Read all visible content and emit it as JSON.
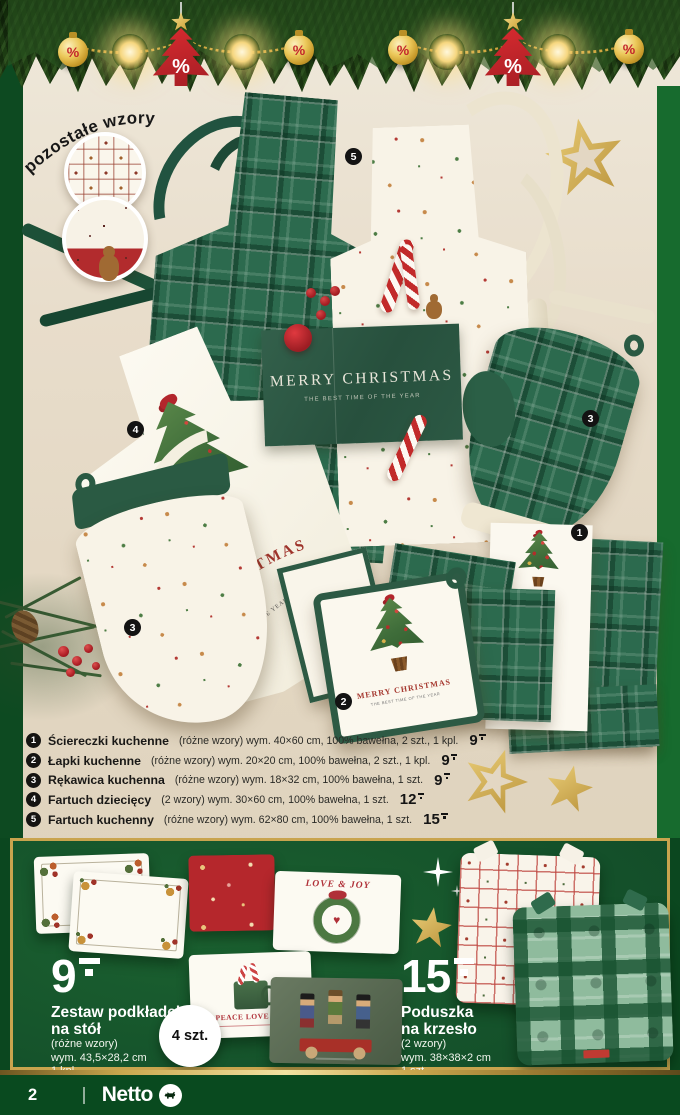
{
  "palette": {
    "page_green": "#0c4b21",
    "panel_green": "#165629",
    "gold": "#c9a44e",
    "accent_red": "#b5272c",
    "beige": "#e6dbc8"
  },
  "garland": {
    "percent": "%"
  },
  "badge_other_patterns": "pozostałe wzory",
  "photo": {
    "tags": [
      "5",
      "4",
      "3",
      "3",
      "1",
      "2"
    ],
    "pocket_line1": "MERRY CHRISTMAS",
    "pocket_line2": "THE BEST TIME OF THE YEAR",
    "child_line1": "MERRY CHRISTMAS",
    "child_line2": "THE BEST TIME OF THE YEAR",
    "towel_line1": "ERRY",
    "towel_line2": "THE BEST TIM",
    "potholder_line1": "MERRY CHRISTMAS",
    "potholder_line2": "THE BEST TIME OF THE YEAR"
  },
  "product_list": [
    {
      "num": "1",
      "name": "Ściereczki kuchenne",
      "details": "(różne wzory) wym. 40×60 cm, 100% bawełna, 2 szt., 1 kpl.",
      "price": "9"
    },
    {
      "num": "2",
      "name": "Łapki kuchenne",
      "details": "(różne wzory) wym. 20×20 cm, 100% bawełna, 2 szt., 1 kpl.",
      "price": "9"
    },
    {
      "num": "3",
      "name": "Rękawica kuchenna",
      "details": "(różne wzory) wym. 18×32 cm, 100% bawełna, 1 szt.",
      "price": "9"
    },
    {
      "num": "4",
      "name": "Fartuch dziecięcy",
      "details": "(2 wzory) wym. 30×60 cm, 100% bawełna, 1 szt.",
      "price": "12"
    },
    {
      "num": "5",
      "name": "Fartuch kuchenny",
      "details": "(różne wzory) wym. 62×80 cm, 100% bawełna, 1 szt.",
      "price": "15"
    }
  ],
  "bottom_panel": {
    "left_offer": {
      "price": "9",
      "title1": "Zestaw podkładek",
      "title2": "na stół",
      "sub1": "(różne wzory)",
      "sub2": "wym. 43,5×28,2 cm",
      "sub3": "1 kpl."
    },
    "count_badge": "4 szt.",
    "right_offer": {
      "price": "15",
      "title1": "Poduszka",
      "title2": "na krzesło",
      "sub1": "(2 wzory)",
      "sub2": "wym. 38×38×2 cm",
      "sub3": "1 szt."
    },
    "placemat_love_joy": "LOVE & JOY",
    "placemat_peace": "PEACE LOVE JOY"
  },
  "footer": {
    "page_number": "2",
    "brand": "Netto"
  }
}
